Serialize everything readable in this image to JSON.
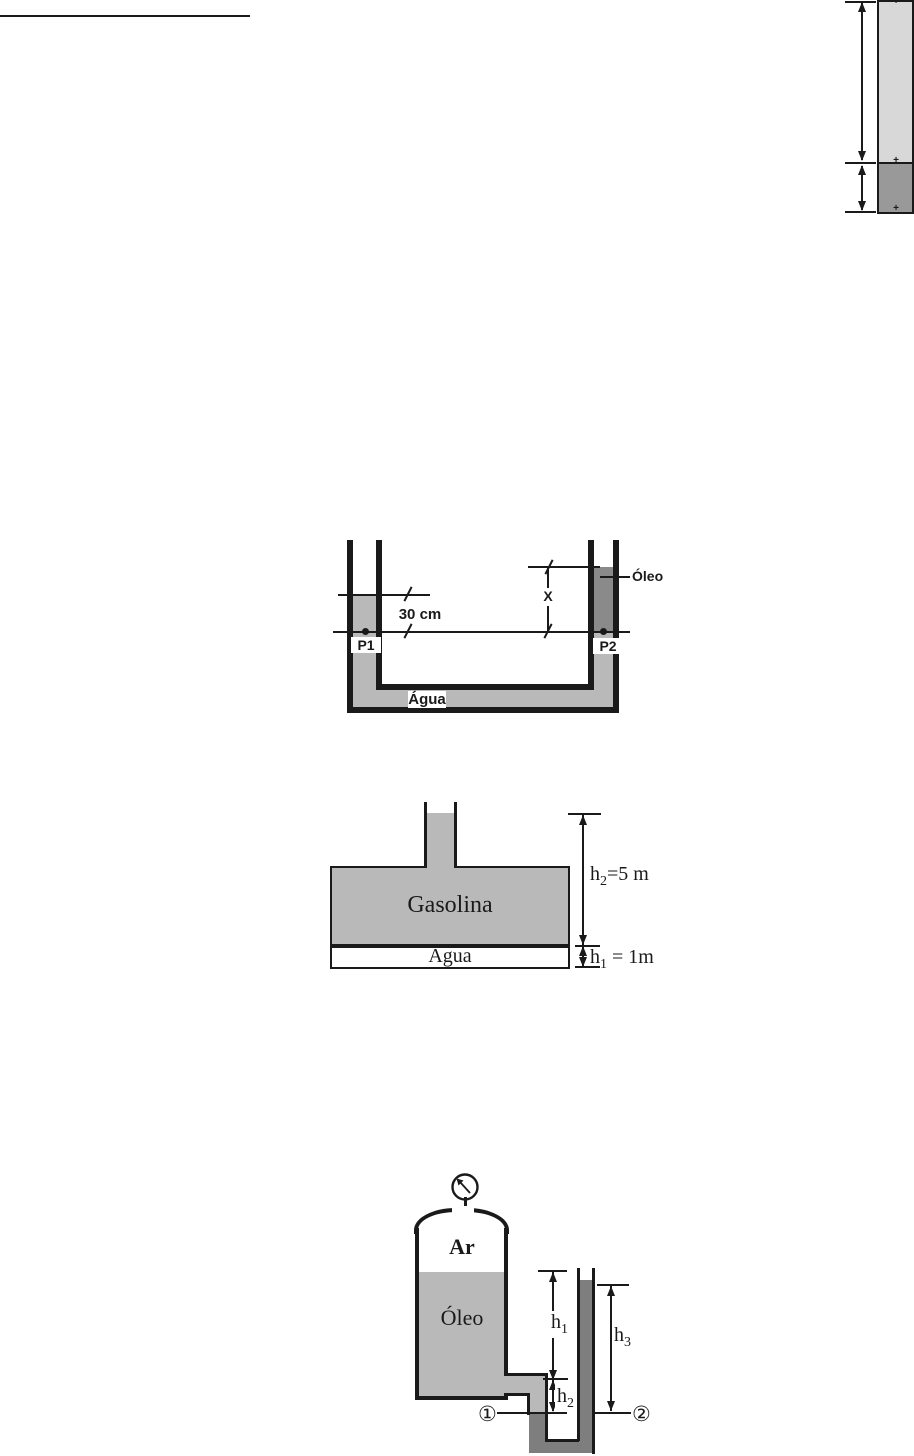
{
  "colors": {
    "ink": "#1a1a1a",
    "light_gray": "#d8d8d8",
    "column_dark": "#999999",
    "water_gray": "#b9b9b9",
    "oil_dark": "#8a8a8a",
    "fluid_dark": "#7e7e7e",
    "tank_gray": "#b9b9b9"
  },
  "top_column": {
    "marker": "+"
  },
  "utube_diagram": {
    "dim_30cm": "30 cm",
    "dim_x": "X",
    "oil_label": "Óleo",
    "p1_label": "P1",
    "p2_label": "P2",
    "water_label": "Água"
  },
  "tank_diagram": {
    "gasoline_label": "Gasolina",
    "water_label": "Água",
    "h2": {
      "base": "h",
      "sub": "2",
      "rest": "=5 m"
    },
    "h1": {
      "base": "h",
      "sub": "1",
      "rest": " = 1m"
    }
  },
  "manometer_diagram": {
    "air_label": "Ar",
    "oil_label": "Óleo",
    "h1": {
      "base": "h",
      "sub": "1"
    },
    "h2": {
      "base": "h",
      "sub": "2"
    },
    "h3": {
      "base": "h",
      "sub": "3"
    },
    "point1": "①",
    "point2": "②"
  }
}
